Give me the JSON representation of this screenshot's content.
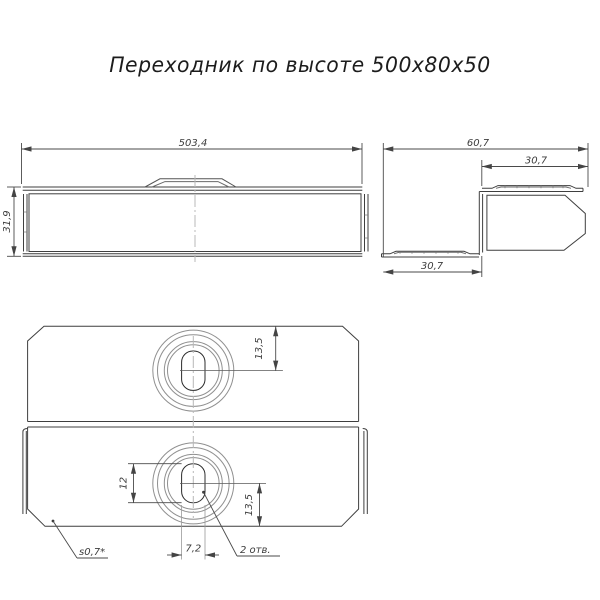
{
  "title": "Переходник по высоте 500х80х50",
  "front_view": {
    "dim_width": "503,4",
    "dim_height": "31,9"
  },
  "side_view": {
    "dim_overall_width": "60,7",
    "dim_top_flange": "30,7",
    "dim_bottom_flange": "30,7"
  },
  "plan_view": {
    "dim_hole_offset_top": "13,5",
    "dim_slot_height": "12",
    "dim_hole_offset_bottom": "13,5",
    "dim_slot_width": "7,2",
    "label_holes_count": "2 отв.",
    "label_sheet_thickness": "s0,7*"
  },
  "colors": {
    "outline": "#3f3f3f",
    "thin_line": "#5a5a5a",
    "ring_line": "#909090",
    "centerline": "#b8b8b8",
    "dim_line": "#4a4a4a"
  }
}
